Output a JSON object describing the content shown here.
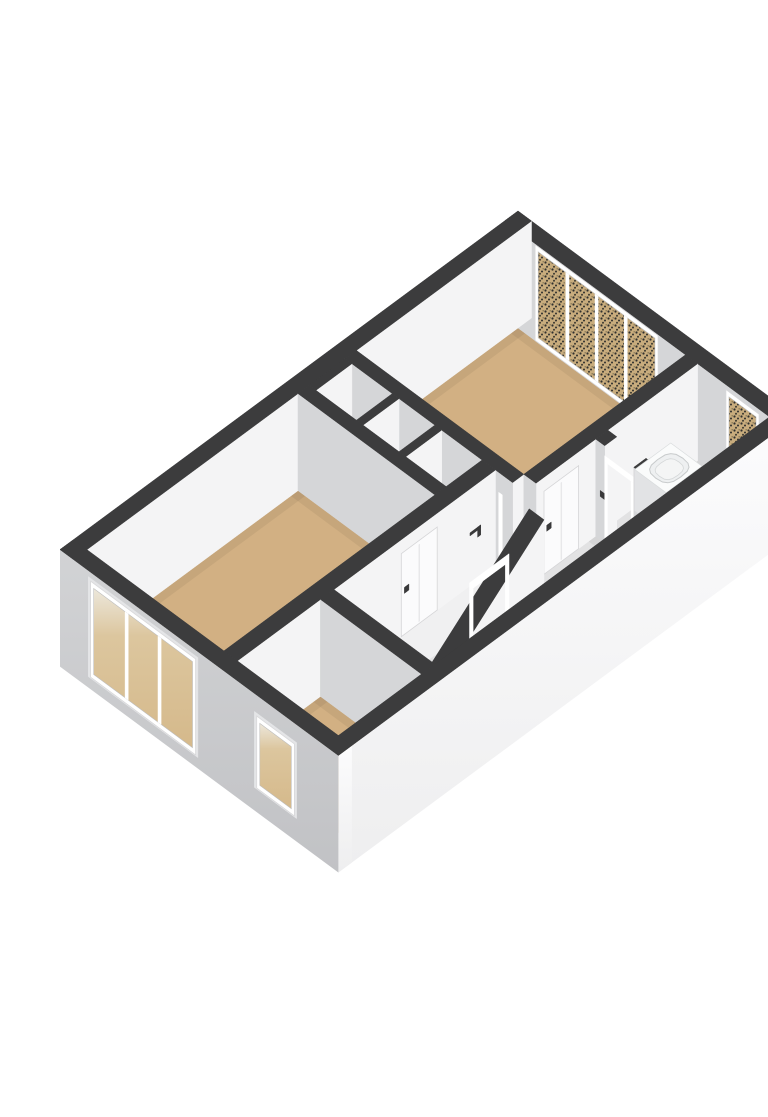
{
  "figure": {
    "title": "3d-floorplan-upper-floor",
    "background": "#ffffff",
    "width": 768,
    "height": 1085
  },
  "projection": {
    "ox": 478,
    "oy": 195,
    "k": 44.9,
    "m": 33.2,
    "floorZ": 97,
    "groundZ": 117
  },
  "palette": {
    "dark": "#3c3c3d",
    "wallSeInt": "#f4f4f5",
    "wallSwInt": "#d5d6d8",
    "frame": "#ffffff",
    "floorTan": "#d2b083",
    "floorWhite": "#f0f0f1",
    "tread": "#f3f3f4",
    "riser": "#dbdcde",
    "handle": "#39393a",
    "ao": "rgba(0,0,0,0.055)",
    "glassTanBase": "#c8ac7d",
    "speckDot": "#30302e",
    "reveal": "#e4e5e7",
    "panel": "#fbfbfc",
    "panelEdge": "#d5d5d7",
    "stairShadow": "#aaabad",
    "sinkTop": "#fafbfb",
    "sinkSe": "#ebecee",
    "sinkSw": "#e2e3e5",
    "basinFill": "#eef0f1",
    "basinEdge": "#c8cbcc"
  },
  "scene": [
    {
      "type": "floor",
      "name": "floor-bedroom-1",
      "rect": [
        0.3,
        0.3,
        4.03,
        3.9
      ],
      "fill": "floorTan",
      "ao": 1
    },
    {
      "type": "floor",
      "name": "floor-bathroom",
      "rect": [
        4.3,
        0.3,
        5.9,
        2.3
      ],
      "fill": "floorWhite",
      "ao": 1
    },
    {
      "type": "floor",
      "name": "floor-closet-1",
      "rect": [
        0.45,
        4.15,
        1.35,
        4.95
      ],
      "fill": "floorWhite"
    },
    {
      "type": "floor",
      "name": "floor-closet-2",
      "rect": [
        1.5,
        4.15,
        2.3,
        4.95
      ],
      "fill": "floorWhite"
    },
    {
      "type": "floor",
      "name": "floor-hall-nook",
      "rect": [
        2.45,
        4.15,
        3.35,
        4.95
      ],
      "fill": "floorWhite"
    },
    {
      "type": "floor",
      "name": "floor-hall-east",
      "rect": [
        4.3,
        2.57,
        5.9,
        7.75
      ],
      "fill": "floorWhite",
      "ao": 1
    },
    {
      "type": "floor",
      "name": "floor-hall-stairs",
      "rect": [
        3.65,
        4.15,
        4.3,
        7.75
      ],
      "fill": "floorWhite"
    },
    {
      "type": "floor",
      "name": "floor-bedroom-2",
      "rect": [
        0.3,
        5.2,
        3.35,
        9.9
      ],
      "fill": "floorTan",
      "ao": 1
    },
    {
      "type": "floor",
      "name": "floor-room-3",
      "rect": [
        3.65,
        8.05,
        5.9,
        9.9
      ],
      "fill": "floorTan",
      "ao": 1
    },
    {
      "type": "wall",
      "name": "wall-exterior-ne",
      "rect": [
        0,
        0,
        6.2,
        0.3
      ],
      "sw": "wallSwInt",
      "swZb": 97,
      "swDecor": [
        {
          "kind": "window",
          "name": "bedroom1-window",
          "span": [
            0.75,
            3.35
          ],
          "z": [
            6,
            92
          ],
          "panes": 4,
          "glass": "speck"
        },
        {
          "kind": "window",
          "name": "bathroom-window",
          "span": [
            5.0,
            5.6
          ],
          "z": [
            10,
            78
          ],
          "panes": 1,
          "glass": "speck"
        }
      ]
    },
    {
      "type": "wall",
      "name": "wall-exterior-nw",
      "rect": [
        0,
        0,
        0.3,
        10.2
      ],
      "se": "wallSeInt",
      "seZb": 97
    },
    {
      "type": "wall",
      "name": "wall-bedroom1-south",
      "rect": [
        0.3,
        3.9,
        4.03,
        4.15
      ],
      "se": "wallSeInt",
      "sw": "wallSwInt"
    },
    {
      "type": "wall",
      "name": "closet-divider-a",
      "rect": [
        0.3,
        4.15,
        0.45,
        4.95
      ],
      "se": "wallSeInt",
      "sw": "wallSwInt"
    },
    {
      "type": "wall",
      "name": "closet-divider-b",
      "rect": [
        1.35,
        4.15,
        1.5,
        4.95
      ],
      "se": "wallSeInt",
      "sw": "wallSwInt"
    },
    {
      "type": "wall",
      "name": "closet-divider-c",
      "rect": [
        2.3,
        4.15,
        2.45,
        4.95
      ],
      "se": "wallSeInt",
      "sw": "wallSwInt"
    },
    {
      "type": "wall",
      "name": "wall-closets-back",
      "rect": [
        0.3,
        4.95,
        3.35,
        5.2
      ],
      "se": "wallSeInt",
      "sw": "wallSwInt"
    },
    {
      "type": "wall",
      "name": "wall-bedroom1-hall",
      "rect": [
        4.03,
        0.3,
        4.3,
        3.9
      ],
      "se": "wallSeInt",
      "sw": "wallSwInt",
      "seDecor": [
        {
          "kind": "panel",
          "name": "bedroom1-door",
          "span": [
            2.95,
            3.72
          ],
          "z": [
            14,
            97
          ]
        },
        {
          "kind": "handle",
          "name": "bedroom1-door-handle",
          "at": 3.56,
          "z": 50
        }
      ]
    },
    {
      "type": "wall",
      "name": "wall-bathroom-a",
      "rect": [
        4.3,
        2.3,
        4.5,
        2.57
      ],
      "se": "wallSeInt",
      "sw": "wallSwInt",
      "swDecor": [
        {
          "kind": "handle",
          "name": "bathroom-door-handle",
          "at": 4.4,
          "z": 48
        }
      ]
    },
    {
      "type": "faceRect",
      "name": "bathroom-door-jamb-left",
      "plane": "v",
      "at": 2.57,
      "span": [
        4.5,
        4.56
      ],
      "z": [
        16,
        97
      ],
      "fill": "frame"
    },
    {
      "type": "faceRect",
      "name": "bathroom-door-jamb-right",
      "plane": "v",
      "at": 2.57,
      "span": [
        5.09,
        5.15
      ],
      "z": [
        16,
        97
      ],
      "fill": "frame"
    },
    {
      "type": "faceRect",
      "name": "bathroom-door-header",
      "plane": "v",
      "at": 2.57,
      "span": [
        4.5,
        5.15
      ],
      "z": [
        10,
        16
      ],
      "fill": "frame"
    },
    {
      "type": "wall",
      "name": "wall-bathroom-b",
      "rect": [
        5.15,
        2.3,
        5.9,
        2.57
      ],
      "se": "wallSeInt",
      "sw": "wallSwInt"
    },
    {
      "type": "box",
      "name": "bathroom-sink",
      "rect": [
        4.35,
        0.95,
        5.05,
        1.75
      ],
      "z": [
        56,
        97
      ],
      "top": "sinkTop",
      "se": "sinkSe",
      "sw": "sinkSw",
      "basin": {
        "cx": 4.7,
        "cy": 1.33,
        "rx": 0.26,
        "ry": 0.3,
        "z": 57
      }
    },
    {
      "type": "wall",
      "name": "wall-bedroom2-hall",
      "rect": [
        3.35,
        4.15,
        3.65,
        9.9
      ],
      "se": "wallSeInt",
      "sw": "wallSwInt",
      "seDecor": [
        {
          "kind": "mark",
          "name": "handrail-bracket",
          "at": 4.48,
          "z": 44
        },
        {
          "kind": "panel",
          "name": "bedroom2-door",
          "span": [
            5.45,
            6.25
          ],
          "z": [
            14,
            97
          ]
        },
        {
          "kind": "handle",
          "name": "bedroom2-door-handle",
          "at": 6.08,
          "z": 50
        }
      ]
    },
    {
      "type": "faceRect",
      "name": "stair-doorframe-post-a",
      "plane": "v",
      "at": 4.15,
      "span": [
        3.72,
        3.8
      ],
      "z": [
        20,
        97
      ],
      "fill": "frame"
    },
    {
      "type": "faceRect",
      "name": "stair-doorframe-post-b",
      "plane": "v",
      "at": 4.15,
      "span": [
        4.38,
        4.46
      ],
      "z": [
        20,
        97
      ],
      "fill": "frame"
    },
    {
      "type": "stairs",
      "name": "staircase",
      "u": [
        3.78,
        4.55
      ],
      "v0": 4.35,
      "dv": 0.26,
      "steps": 6,
      "riser": 8,
      "z0": 97,
      "winders": [
        {
          "pts": [
            [
              3.78,
              5.91
            ],
            [
              4.55,
              5.91
            ],
            [
              4.55,
              6.2
            ],
            [
              3.78,
              6.05
            ]
          ],
          "z": 150,
          "riserEdge": 2
        },
        {
          "pts": [
            [
              3.78,
              6.05
            ],
            [
              4.55,
              6.2
            ],
            [
              4.45,
              6.52
            ],
            [
              3.78,
              6.2
            ]
          ],
          "z": 154,
          "riserEdge": 2
        },
        {
          "pts": [
            [
              3.78,
              6.2
            ],
            [
              4.45,
              6.52
            ],
            [
              4.15,
              6.72
            ],
            [
              3.78,
              6.35
            ]
          ],
          "z": 158,
          "riserEdge": 2
        }
      ],
      "shadow": {
        "pts": [
          [
            3.78,
            6.35
          ],
          [
            4.15,
            6.72
          ],
          [
            3.78,
            6.72
          ]
        ],
        "z": 163,
        "fill": "stairShadow"
      }
    },
    {
      "type": "rake",
      "name": "stair-balustrade",
      "u": [
        4.55,
        4.88
      ],
      "v": [
        4.3,
        6.95
      ],
      "zTop": [
        4,
        104
      ],
      "seBot": [
        97,
        130
      ]
    },
    {
      "type": "faceRect",
      "name": "hall-doorframe-post-a",
      "plane": "u",
      "at": 4.88,
      "span": [
        5.08,
        5.16
      ],
      "z": [
        20,
        97
      ],
      "fill": "frame"
    },
    {
      "type": "faceRect",
      "name": "hall-doorframe-post-b",
      "plane": "u",
      "at": 4.88,
      "span": [
        5.88,
        5.96
      ],
      "z": [
        20,
        97
      ],
      "fill": "frame"
    },
    {
      "type": "faceRect",
      "name": "hall-doorframe-header",
      "plane": "u",
      "at": 4.88,
      "span": [
        5.08,
        5.96
      ],
      "z": [
        12,
        20
      ],
      "fill": "frame"
    },
    {
      "type": "wall",
      "name": "wall-room3-north",
      "rect": [
        3.65,
        7.75,
        5.9,
        8.05
      ],
      "se": "wallSeInt",
      "sw": "wallSwInt"
    },
    {
      "type": "wall",
      "name": "wall-exterior-se",
      "rect": [
        5.9,
        0,
        6.2,
        10.2
      ],
      "se": "gSE",
      "seZb": 117
    },
    {
      "type": "wall",
      "name": "wall-exterior-sw",
      "rect": [
        0,
        9.9,
        6.2,
        10.2
      ],
      "se": "gSE",
      "seZb": 117,
      "sw": "gSW",
      "swZb": 117,
      "swDecor": [
        {
          "kind": "window",
          "name": "bedroom2-window",
          "span": [
            0.75,
            2.95
          ],
          "z": [
            14,
            100
          ],
          "panes": 3,
          "glass": "gGlass",
          "reveal": 1
        },
        {
          "kind": "window",
          "name": "room3-window",
          "span": [
            4.45,
            5.15
          ],
          "z": [
            26,
            88
          ],
          "panes": 1,
          "glass": "gGlass",
          "reveal": 1
        }
      ]
    }
  ]
}
